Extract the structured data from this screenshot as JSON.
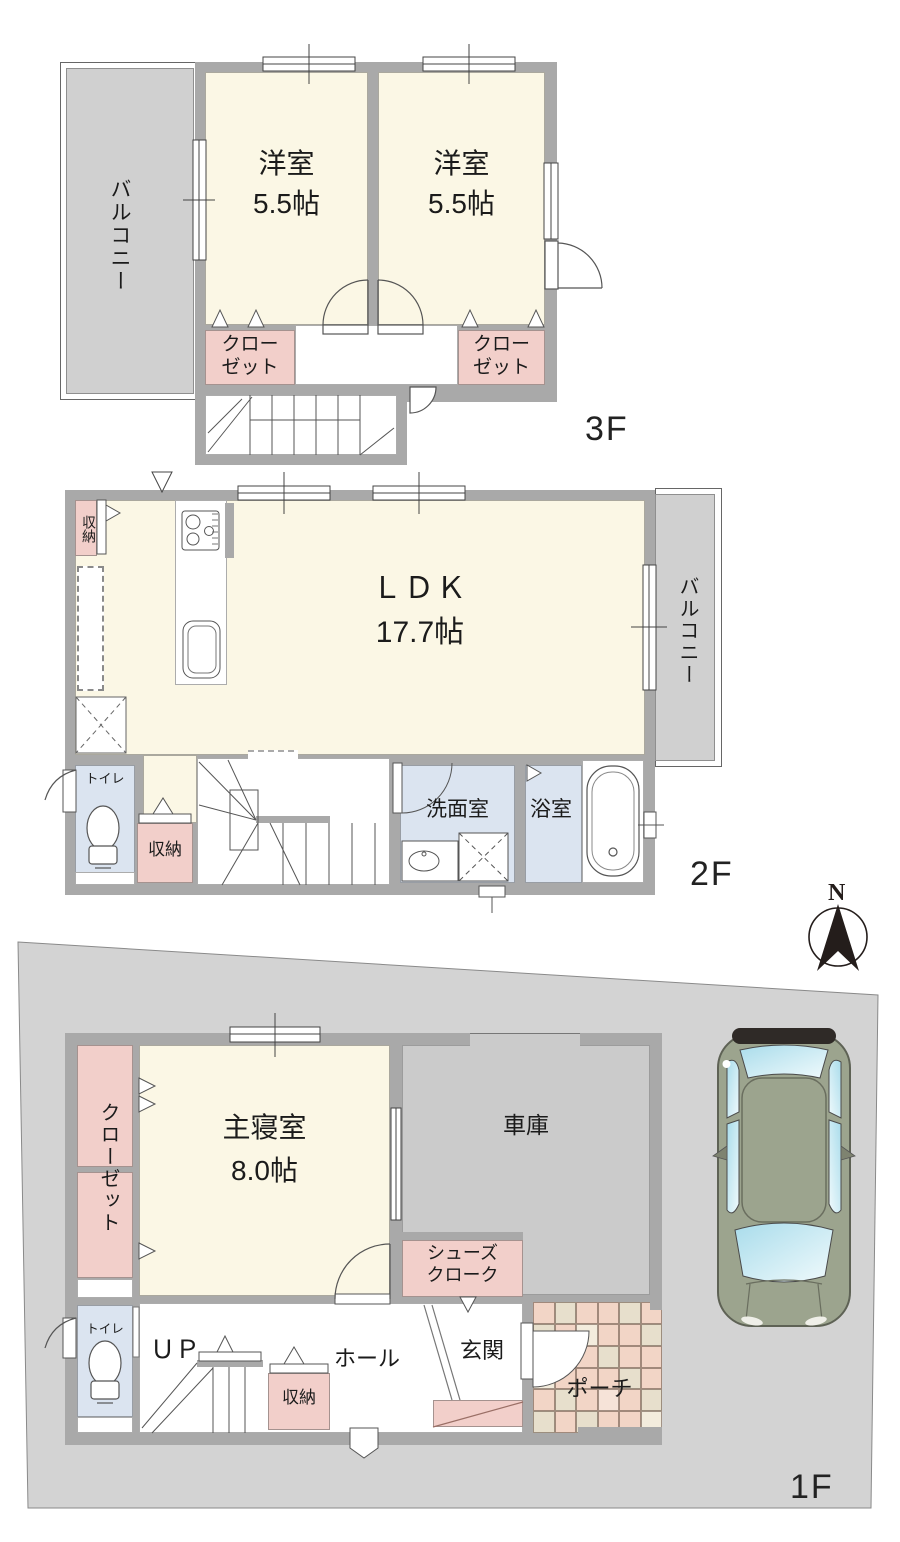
{
  "floor3": {
    "label": "3F",
    "balcony": "バルコニー",
    "room1_name": "洋室",
    "room1_size": "5.5帖",
    "room2_name": "洋室",
    "room2_size": "5.5帖",
    "closet_line1": "クロー",
    "closet_line2": "ゼット"
  },
  "floor2": {
    "label": "2F",
    "storage_top": "収納",
    "ldk_name": "ＬＤＫ",
    "ldk_size": "17.7帖",
    "balcony": "バルコニー",
    "toilet": "トイレ",
    "storage_bottom": "収納",
    "washroom": "洗面室",
    "bathroom": "浴室"
  },
  "floor1": {
    "label": "1F",
    "closet": "クローゼット",
    "bedroom_name": "主寝室",
    "bedroom_size": "8.0帖",
    "garage": "車庫",
    "shoes_line1": "シューズ",
    "shoes_line2": "クローク",
    "toilet": "トイレ",
    "stairs_up": "ＵＰ",
    "storage": "収納",
    "hall": "ホール",
    "entrance": "玄関",
    "porch": "ポーチ"
  },
  "compass": {
    "north": "N"
  },
  "colors": {
    "wall": "#a9a9a9",
    "room_cream": "#fbf7e5",
    "closet_pink": "#f2cfca",
    "wet_blue": "#dbe4f0",
    "lot_gray": "#d3d3d3",
    "balcony_gray": "#d0d0d0",
    "garage_gray": "#cbcbcb",
    "car_body": "#9ca48e",
    "porch_tiles": [
      "#f2d5c6",
      "#e7dfcc",
      "#f6e3d8",
      "#f3ecdd"
    ]
  }
}
